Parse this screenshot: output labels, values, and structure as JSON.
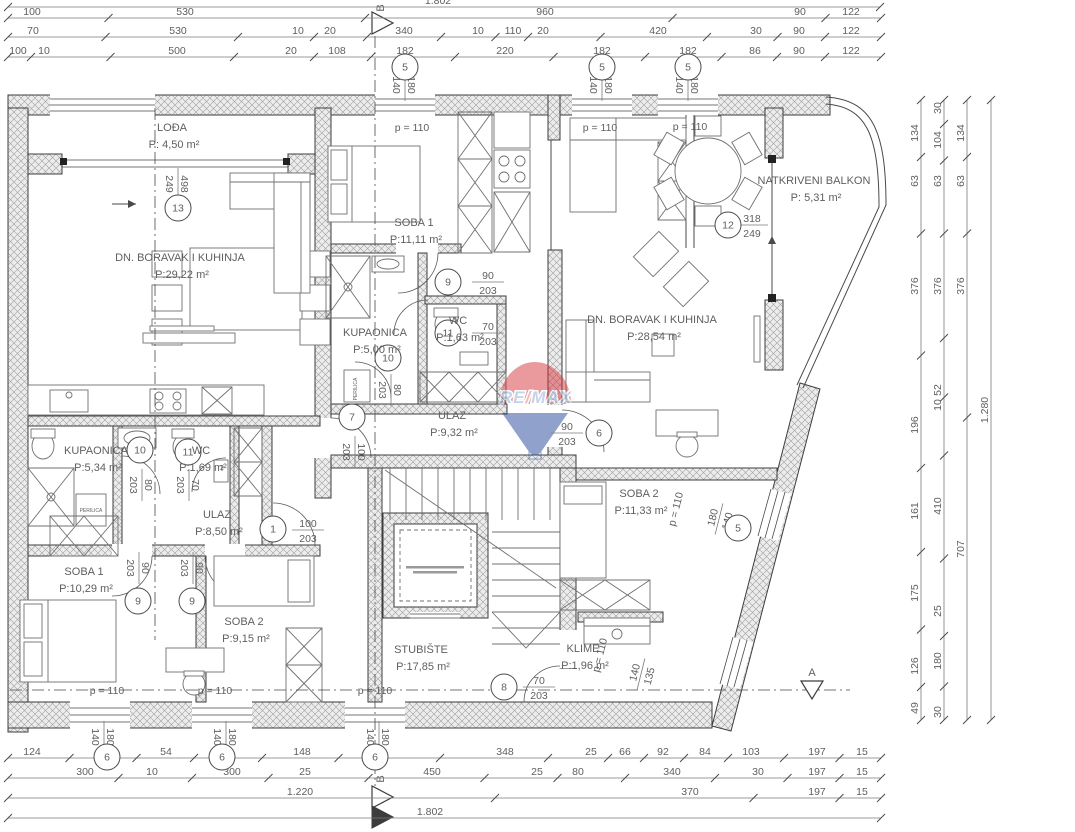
{
  "plan": {
    "rooms": [
      {
        "name": "LOĐA",
        "area": "P: 4,50 m²",
        "x": 172,
        "y": 131
      },
      {
        "name": "DN. BORAVAK I KUHINJA",
        "area": "P:29,22 m²",
        "x": 180,
        "y": 261
      },
      {
        "name": "SOBA 1",
        "area": "P:11,11 m²",
        "x": 414,
        "y": 226
      },
      {
        "name": "KUPAONICA",
        "area": "P:5,00 m²",
        "x": 375,
        "y": 336
      },
      {
        "name": "WC",
        "area": "P:1,63 m²",
        "x": 458,
        "y": 324
      },
      {
        "name": "ULAZ",
        "area": "P:9,32 m²",
        "x": 452,
        "y": 419
      },
      {
        "name": "NATKRIVENI BALKON",
        "area": "P: 5,31 m²",
        "x": 814,
        "y": 184
      },
      {
        "name": "DN. BORAVAK I KUHINJA",
        "area": "P:28,54 m²",
        "x": 652,
        "y": 323
      },
      {
        "name": "KUPAONICA",
        "area": "P:5,34 m²",
        "x": 96,
        "y": 454
      },
      {
        "name": "WC",
        "area": "P:1,69 m²",
        "x": 201,
        "y": 454
      },
      {
        "name": "ULAZ",
        "area": "P:8,50 m²",
        "x": 217,
        "y": 518
      },
      {
        "name": "SOBA 1",
        "area": "P:10,29 m²",
        "x": 84,
        "y": 575
      },
      {
        "name": "SOBA 2",
        "area": "P:9,15 m²",
        "x": 244,
        "y": 625
      },
      {
        "name": "STUBIŠTE",
        "area": "P:17,85 m²",
        "x": 421,
        "y": 653
      },
      {
        "name": "SOBA 2",
        "area": "P:11,33 m²",
        "x": 639,
        "y": 497
      },
      {
        "name": "KLIME",
        "area": "P:1,96 m²",
        "x": 583,
        "y": 652
      }
    ],
    "parapets": [
      {
        "t": "p = 110",
        "x": 412,
        "y": 131,
        "rot": 0
      },
      {
        "t": "p = 110",
        "x": 600,
        "y": 131,
        "rot": 0
      },
      {
        "t": "p = 110",
        "x": 690,
        "y": 130,
        "rot": 0
      },
      {
        "t": "p = 110",
        "x": 107,
        "y": 694,
        "rot": 0
      },
      {
        "t": "p = 110",
        "x": 215,
        "y": 694,
        "rot": 0
      },
      {
        "t": "p = 110",
        "x": 375,
        "y": 694,
        "rot": 0
      },
      {
        "t": "p = 110",
        "x": 679,
        "y": 510,
        "rot": -76
      },
      {
        "t": "p = 110",
        "x": 603,
        "y": 656,
        "rot": -76
      }
    ],
    "fractions": [
      {
        "t": "498",
        "b": "249",
        "x": 178,
        "y": 184,
        "rot": 90
      },
      {
        "t": "318",
        "b": "249",
        "x": 752,
        "y": 225,
        "rot": 0
      },
      {
        "t": "90",
        "b": "203",
        "x": 488,
        "y": 282,
        "rot": 0
      },
      {
        "t": "70",
        "b": "203",
        "x": 488,
        "y": 333,
        "rot": 0
      },
      {
        "t": "80",
        "b": "203",
        "x": 391,
        "y": 390,
        "rot": 90
      },
      {
        "t": "100",
        "b": "203",
        "x": 355,
        "y": 452,
        "rot": 90
      },
      {
        "t": "90",
        "b": "203",
        "x": 567,
        "y": 433,
        "rot": 0
      },
      {
        "t": "80",
        "b": "203",
        "x": 142,
        "y": 485,
        "rot": 90
      },
      {
        "t": "70",
        "b": "203",
        "x": 189,
        "y": 485,
        "rot": 90
      },
      {
        "t": "100",
        "b": "203",
        "x": 308,
        "y": 530,
        "rot": 0
      },
      {
        "t": "90",
        "b": "203",
        "x": 139,
        "y": 568,
        "rot": 90
      },
      {
        "t": "90",
        "b": "203",
        "x": 193,
        "y": 568,
        "rot": 90
      },
      {
        "t": "70",
        "b": "203",
        "x": 539,
        "y": 687,
        "rot": 0
      },
      {
        "t": "180",
        "b": "140",
        "x": 719,
        "y": 519,
        "rot": -76
      },
      {
        "t": "140",
        "b": "135",
        "x": 641,
        "y": 674,
        "rot": -76
      },
      {
        "t": "180",
        "b": "140",
        "x": 405,
        "y": 85,
        "rot": 90
      },
      {
        "t": "180",
        "b": "140",
        "x": 602,
        "y": 85,
        "rot": 90
      },
      {
        "t": "180",
        "b": "140",
        "x": 688,
        "y": 85,
        "rot": 90
      },
      {
        "t": "180",
        "b": "140",
        "x": 104,
        "y": 737,
        "rot": 90
      },
      {
        "t": "180",
        "b": "140",
        "x": 226,
        "y": 737,
        "rot": 90
      },
      {
        "t": "180",
        "b": "140",
        "x": 379,
        "y": 737,
        "rot": 90
      }
    ],
    "circles": [
      {
        "n": "5",
        "x": 405,
        "y": 67
      },
      {
        "n": "5",
        "x": 602,
        "y": 67
      },
      {
        "n": "5",
        "x": 688,
        "y": 67
      },
      {
        "n": "13",
        "x": 178,
        "y": 208
      },
      {
        "n": "12",
        "x": 728,
        "y": 225
      },
      {
        "n": "9",
        "x": 448,
        "y": 282
      },
      {
        "n": "11",
        "x": 448,
        "y": 333
      },
      {
        "n": "10",
        "x": 388,
        "y": 358
      },
      {
        "n": "7",
        "x": 352,
        "y": 417
      },
      {
        "n": "6",
        "x": 599,
        "y": 433
      },
      {
        "n": "10",
        "x": 140,
        "y": 450
      },
      {
        "n": "11",
        "x": 188,
        "y": 452
      },
      {
        "n": "1",
        "x": 273,
        "y": 529
      },
      {
        "n": "9",
        "x": 138,
        "y": 601
      },
      {
        "n": "9",
        "x": 192,
        "y": 601
      },
      {
        "n": "8",
        "x": 504,
        "y": 687
      },
      {
        "n": "5",
        "x": 738,
        "y": 528
      },
      {
        "n": "6",
        "x": 107,
        "y": 757
      },
      {
        "n": "6",
        "x": 222,
        "y": 757
      },
      {
        "n": "6",
        "x": 375,
        "y": 757
      }
    ],
    "dims": {
      "rows": [
        {
          "y": 7,
          "x1": 8,
          "x2": 880,
          "labels": [
            {
              "t": "1.802",
              "x": 438
            }
          ]
        },
        {
          "y": 18,
          "x1": 8,
          "x2": 881,
          "labels": [
            {
              "t": "100",
              "x": 32
            },
            {
              "t": "530",
              "x": 185
            },
            {
              "t": "960",
              "x": 545
            },
            {
              "t": "90",
              "x": 800
            },
            {
              "t": "122",
              "x": 851
            }
          ]
        },
        {
          "y": 37,
          "x1": 8,
          "x2": 881,
          "labels": [
            {
              "t": "70",
              "x": 33
            },
            {
              "t": "530",
              "x": 178
            },
            {
              "t": "10",
              "x": 298
            },
            {
              "t": "20",
              "x": 330
            },
            {
              "t": "340",
              "x": 404
            },
            {
              "t": "10",
              "x": 478
            },
            {
              "t": "110",
              "x": 513
            },
            {
              "t": "20",
              "x": 543
            },
            {
              "t": "420",
              "x": 658
            },
            {
              "t": "30",
              "x": 756
            },
            {
              "t": "90",
              "x": 799
            },
            {
              "t": "122",
              "x": 851
            }
          ]
        },
        {
          "y": 57,
          "x1": 8,
          "x2": 881,
          "labels": [
            {
              "t": "100",
              "x": 18
            },
            {
              "t": "10",
              "x": 44
            },
            {
              "t": "500",
              "x": 177
            },
            {
              "t": "20",
              "x": 291
            },
            {
              "t": "108",
              "x": 337
            },
            {
              "t": "182",
              "x": 405
            },
            {
              "t": "220",
              "x": 505
            },
            {
              "t": "182",
              "x": 602
            },
            {
              "t": "182",
              "x": 688
            },
            {
              "t": "86",
              "x": 755
            },
            {
              "t": "90",
              "x": 799
            },
            {
              "t": "122",
              "x": 851
            }
          ]
        },
        {
          "y": 758,
          "x1": 8,
          "x2": 881,
          "labels": [
            {
              "t": "124",
              "x": 32
            },
            {
              "t": "182",
              "x": 107
            },
            {
              "t": "54",
              "x": 166
            },
            {
              "t": "182",
              "x": 222
            },
            {
              "t": "148",
              "x": 302
            },
            {
              "t": "182",
              "x": 375
            },
            {
              "t": "348",
              "x": 505
            },
            {
              "t": "25",
              "x": 591
            },
            {
              "t": "66",
              "x": 625
            },
            {
              "t": "92",
              "x": 663
            },
            {
              "t": "84",
              "x": 705
            },
            {
              "t": "103",
              "x": 751
            },
            {
              "t": "197",
              "x": 817
            },
            {
              "t": "15",
              "x": 862
            }
          ]
        },
        {
          "y": 778,
          "x1": 8,
          "x2": 881,
          "labels": [
            {
              "t": "300",
              "x": 85
            },
            {
              "t": "10",
              "x": 152
            },
            {
              "t": "300",
              "x": 232
            },
            {
              "t": "25",
              "x": 305
            },
            {
              "t": "450",
              "x": 432
            },
            {
              "t": "25",
              "x": 537
            },
            {
              "t": "80",
              "x": 578
            },
            {
              "t": "340",
              "x": 672
            },
            {
              "t": "30",
              "x": 758
            },
            {
              "t": "197",
              "x": 817
            },
            {
              "t": "15",
              "x": 862
            }
          ]
        },
        {
          "y": 798,
          "x1": 8,
          "x2": 881,
          "labels": [
            {
              "t": "1.220",
              "x": 300
            },
            {
              "t": "370",
              "x": 690
            },
            {
              "t": "197",
              "x": 817
            },
            {
              "t": "15",
              "x": 862
            }
          ]
        },
        {
          "y": 818,
          "x1": 8,
          "x2": 881,
          "labels": [
            {
              "t": "1.802",
              "x": 430
            }
          ]
        }
      ],
      "cols": [
        {
          "x": 921,
          "y1": 100,
          "y2": 720,
          "labels": [
            {
              "t": "134",
              "y": 133
            },
            {
              "t": "63",
              "y": 181
            },
            {
              "t": "376",
              "y": 286
            },
            {
              "t": "196",
              "y": 425
            },
            {
              "t": "161",
              "y": 511
            },
            {
              "t": "175",
              "y": 593
            },
            {
              "t": "126",
              "y": 666
            },
            {
              "t": "49",
              "y": 708
            }
          ]
        },
        {
          "x": 944,
          "y1": 100,
          "y2": 720,
          "labels": [
            {
              "t": "30",
              "y": 108
            },
            {
              "t": "104",
              "y": 140
            },
            {
              "t": "63",
              "y": 181
            },
            {
              "t": "376",
              "y": 286
            },
            {
              "t": "52",
              "y": 390
            },
            {
              "t": "10",
              "y": 405
            },
            {
              "t": "410",
              "y": 506
            },
            {
              "t": "25",
              "y": 611
            },
            {
              "t": "180",
              "y": 661
            },
            {
              "t": "30",
              "y": 712
            }
          ]
        },
        {
          "x": 967,
          "y1": 100,
          "y2": 720,
          "labels": [
            {
              "t": "134",
              "y": 133
            },
            {
              "t": "63",
              "y": 181
            },
            {
              "t": "376",
              "y": 286
            },
            {
              "t": "707",
              "y": 549
            }
          ]
        },
        {
          "x": 991,
          "y1": 100,
          "y2": 720,
          "labels": [
            {
              "t": "1.280",
              "y": 410
            }
          ]
        }
      ]
    },
    "small_labels": [
      {
        "t": "PERILICA",
        "x": 91,
        "y": 512,
        "rot": 0,
        "size": 5
      },
      {
        "t": "PERILICA",
        "x": 357,
        "y": 389,
        "rot": -90,
        "size": 5
      },
      {
        "t": "2",
        "x": 222,
        "y": 470,
        "rot": 0,
        "size": 7
      }
    ],
    "sections": {
      "top_b": "B",
      "bottom_b": "B",
      "right_a": "A"
    },
    "arrows": {
      "loggia": "→",
      "balcony": "↑"
    },
    "logo": {
      "re": "RE",
      "slash": "/",
      "max": "MAX",
      "red": "#d6353c",
      "blue": "#24489b",
      "text_blue": "#8fa8d4",
      "text_red": "#d97b80"
    }
  }
}
